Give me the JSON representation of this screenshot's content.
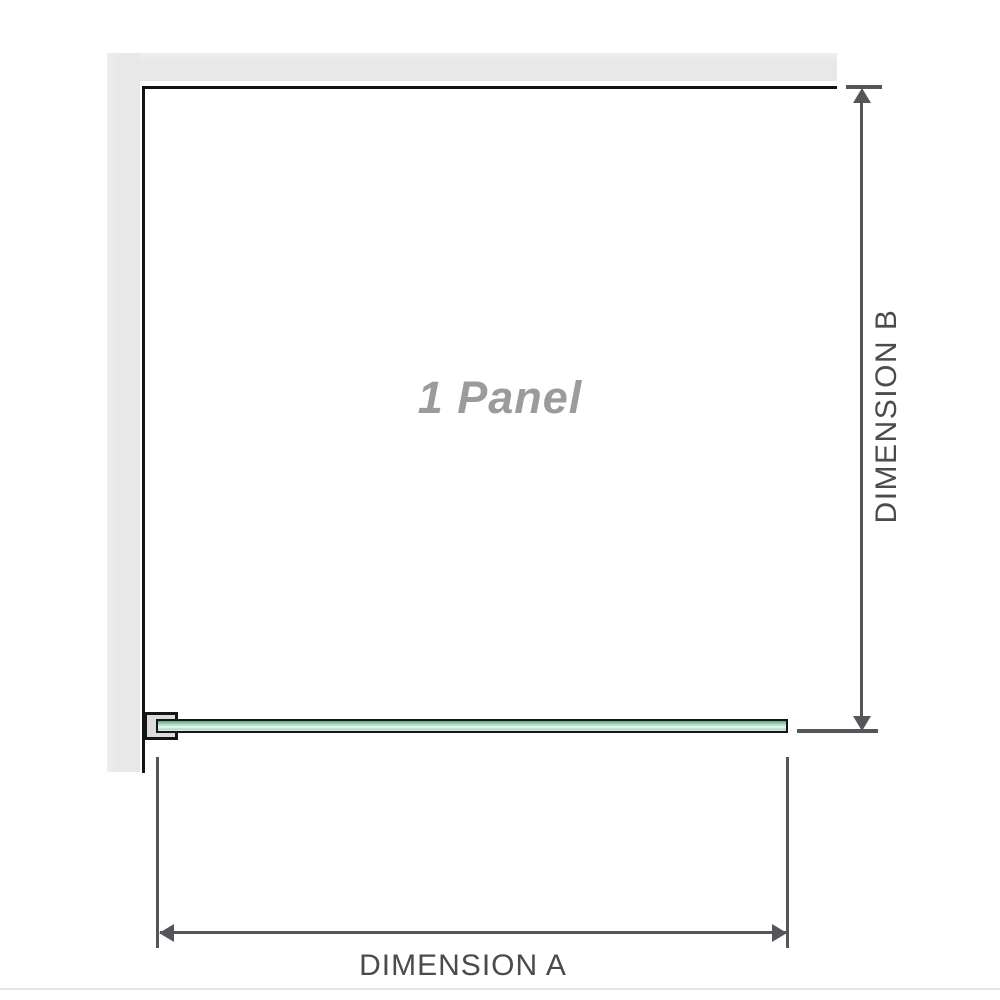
{
  "diagram": {
    "panel_label": "1 Panel",
    "dimensions": {
      "a_label": "DIMENSION A",
      "b_label": "DIMENSION B"
    },
    "colors": {
      "wall_gray": "#e8e8e8",
      "outline_black": "#141414",
      "dimension_line_gray": "#55565a",
      "dimension_text_gray": "#4a4b4e",
      "panel_label_gray": "#9b9b9b",
      "glass_green": "#8fc9ab",
      "glass_green_dark": "#5fa184",
      "glass_green_light": "#e9f8f0",
      "bracket_fill_gray": "#dcdcdc",
      "footer_divider_gray": "#e5e5e5",
      "background": "#ffffff"
    }
  }
}
